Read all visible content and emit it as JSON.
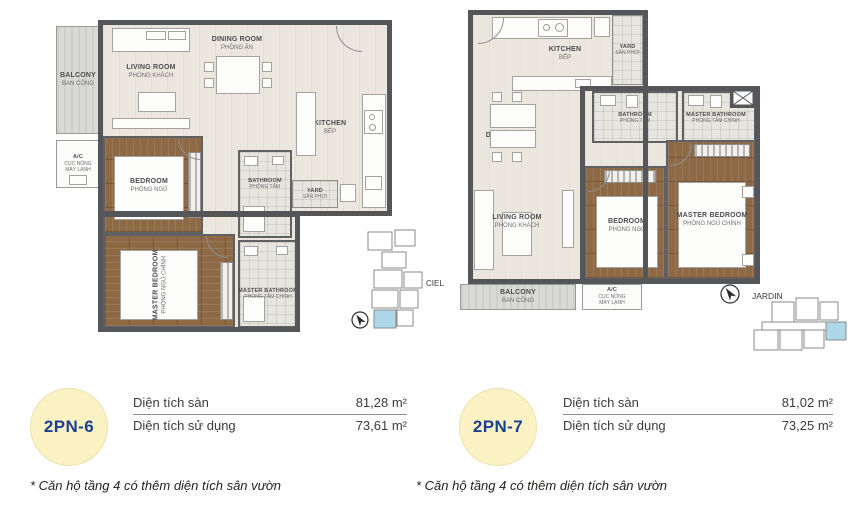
{
  "colors": {
    "wall": "#55565a",
    "wood_floor": "#8d6946",
    "highlight_unit": "#aed7e9",
    "badge_yellow": "#faf2c3",
    "unit_text_blue": "#1c3f90"
  },
  "plans": [
    {
      "locator": {
        "label": "CIEL"
      },
      "rooms": {
        "balcony": {
          "en": "BALCONY",
          "vi": "BAN CÔNG"
        },
        "living": {
          "en": "LIVING ROOM",
          "vi": "PHÒNG KHÁCH"
        },
        "dining": {
          "en": "DINING ROOM",
          "vi": "PHÒNG ĂN"
        },
        "kitchen": {
          "en": "KITCHEN",
          "vi": "BẾP"
        },
        "ac": {
          "l1": "A/C",
          "l2": "CỤC NÓNG",
          "l3": "MÁY LẠNH"
        },
        "bedroom": {
          "en": "BEDROOM",
          "vi": "PHÒNG NGỦ"
        },
        "master_bedroom": {
          "en": "MASTER BEDROOM",
          "vi": "PHÒNG NGỦ CHÍNH"
        },
        "bathroom": {
          "en": "BATHROOM",
          "vi": "PHÒNG TẮM"
        },
        "master_bathroom": {
          "en": "MASTER BATHROOM",
          "vi": "PHÒNG TẮM CHÍNH"
        },
        "yard": {
          "en": "YARD",
          "vi": "SÂN PHƠI"
        }
      },
      "info": {
        "unit": "2PN-6",
        "rows": [
          {
            "label": "Diện tích sàn",
            "value": "81,28 m²"
          },
          {
            "label": "Diện tích sử dụng",
            "value": "73,61 m²"
          }
        ]
      },
      "footnote": "* Căn hộ tầng 4 có thêm diện tích sân vườn"
    },
    {
      "locator": {
        "label": "JARDIN"
      },
      "rooms": {
        "balcony": {
          "en": "BALCONY",
          "vi": "BAN CÔNG"
        },
        "living": {
          "en": "LIVING ROOM",
          "vi": "PHÒNG KHÁCH"
        },
        "dining": {
          "en": "DINING ROOM",
          "vi": "PHÒNG ĂN"
        },
        "kitchen": {
          "en": "KITCHEN",
          "vi": "BẾP"
        },
        "ac": {
          "l1": "A/C",
          "l2": "CỤC NÓNG",
          "l3": "MÁY LẠNH"
        },
        "bedroom": {
          "en": "BEDROOM",
          "vi": "PHÒNG NGỦ"
        },
        "master_bedroom": {
          "en": "MASTER BEDROOM",
          "vi": "PHÒNG NGỦ CHÍNH"
        },
        "bathroom": {
          "en": "BATHROOM",
          "vi": "PHÒNG TẮM"
        },
        "master_bathroom": {
          "en": "MASTER BATHROOM",
          "vi": "PHÒNG TẮM CHÍNH"
        },
        "yard": {
          "en": "YARD",
          "vi": "SÂN PHƠI"
        }
      },
      "info": {
        "unit": "2PN-7",
        "rows": [
          {
            "label": "Diện tích sàn",
            "value": "81,02 m²"
          },
          {
            "label": "Diện tích sử dụng",
            "value": "73,25 m²"
          }
        ]
      },
      "footnote": "* Căn hộ tầng 4 có thêm diện tích sân vườn"
    }
  ]
}
